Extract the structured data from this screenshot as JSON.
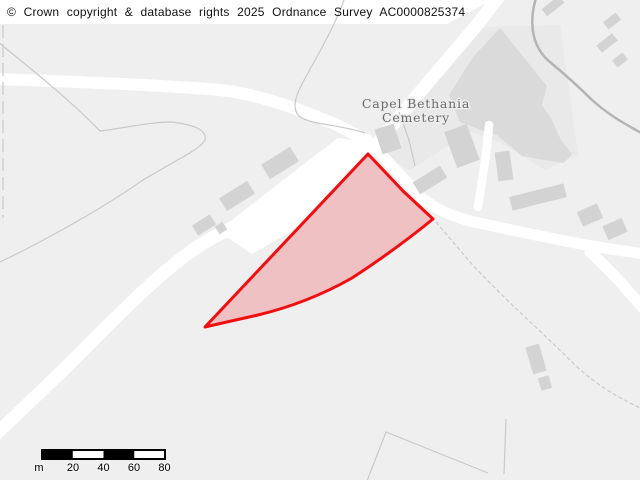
{
  "banner": {
    "copyright": "© Crown copyright & database rights 2025 Ordnance Survey AC0000825374"
  },
  "map": {
    "place_labels": {
      "cemetery": [
        "Capel Bethania",
        "Cemetery"
      ]
    },
    "scale_bar": {
      "unit": "m",
      "tick_labels": [
        "20",
        "40",
        "60",
        "80"
      ]
    },
    "colors": {
      "background": "#efefef",
      "road": "#ffffff",
      "building": "#d3d3d3",
      "cemetery_fill": "#dadada",
      "cemetery_surround": "#e9e9e9",
      "parcel_stroke": "#f10e10",
      "parcel_fill": "rgba(240,25,35,0.21)",
      "track": "#b4b4b4",
      "contour": "#c9c9c9"
    }
  }
}
